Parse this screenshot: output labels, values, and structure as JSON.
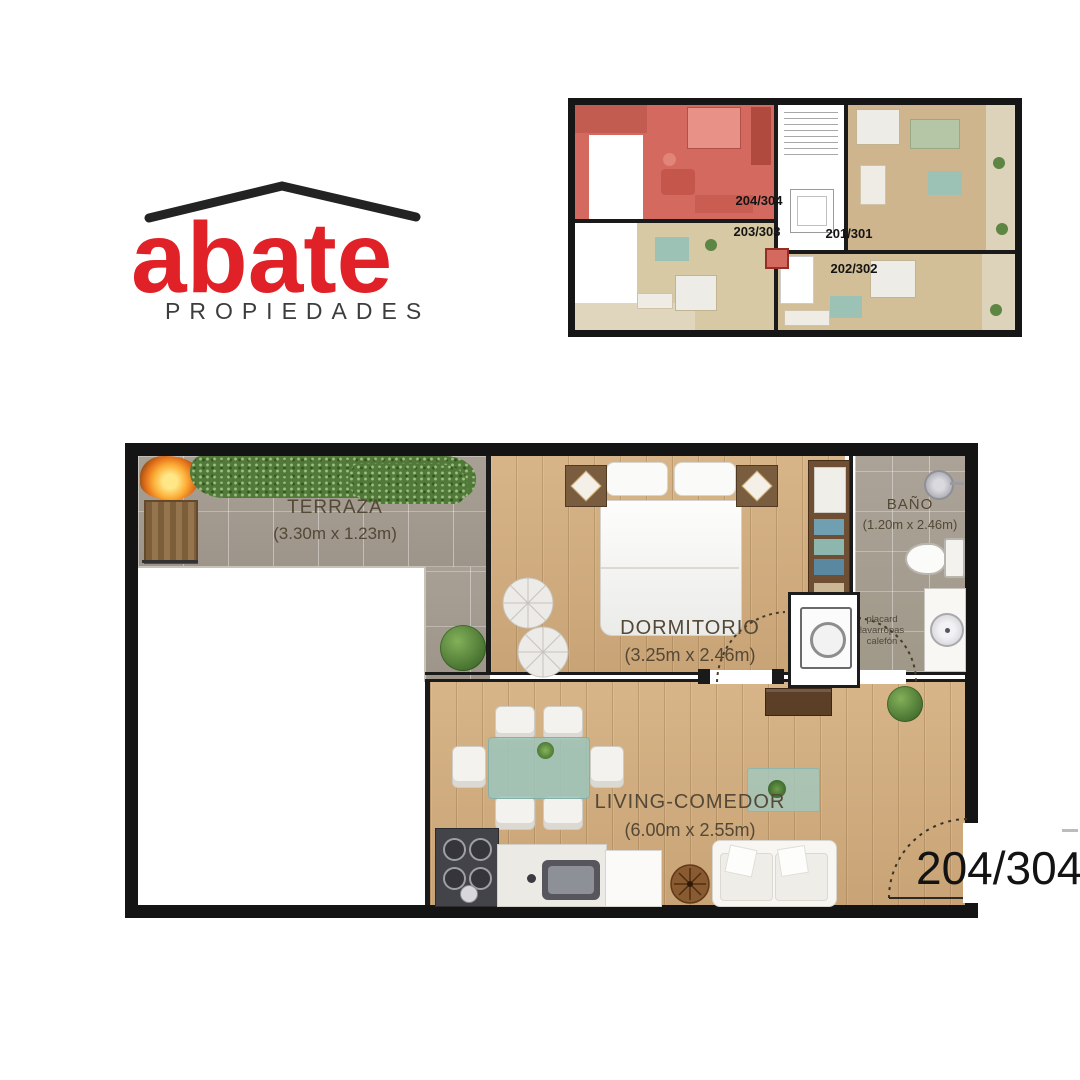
{
  "logo": {
    "brand": "abate",
    "tagline": "PROPIEDADES",
    "brand_color": "#e02127",
    "roof_color": "#232323",
    "tagline_color": "#3d3d3d"
  },
  "overview_plan": {
    "highlight_color": "#d4695f",
    "units": [
      {
        "label": "204/304",
        "highlighted": true
      },
      {
        "label": "203/303",
        "highlighted": false
      },
      {
        "label": "201/301",
        "highlighted": false
      },
      {
        "label": "202/302",
        "highlighted": false
      }
    ]
  },
  "main_plan": {
    "unit_label": "204/304",
    "rooms": [
      {
        "name": "TERRAZA",
        "dimensions": "(3.30m x 1.23m)"
      },
      {
        "name": "DORMITORIO",
        "dimensions": "(3.25m x 2.46m)"
      },
      {
        "name": "BAÑO",
        "dimensions": "(1.20m x 2.46m)"
      },
      {
        "name": "LIVING-COMEDOR",
        "dimensions": "(6.00m x 2.55m)"
      }
    ],
    "utility_labels": [
      "placard",
      "lavarropas",
      "calefón"
    ]
  }
}
